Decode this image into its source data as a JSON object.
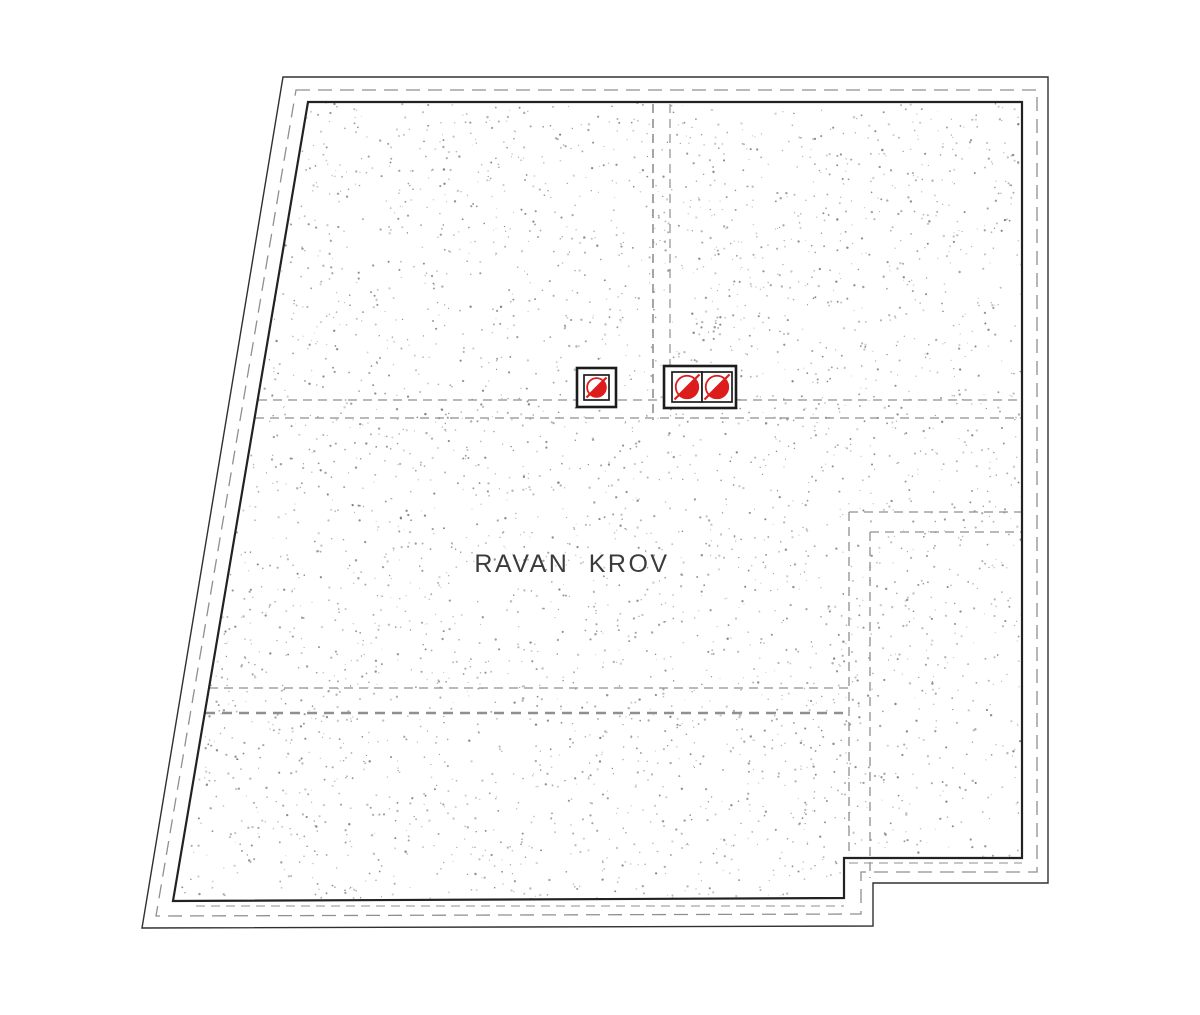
{
  "drawing": {
    "label": {
      "text": "RAVAN KROV"
    },
    "colors": {
      "background": "#ffffff",
      "outline": "#303030",
      "inner_outline": "#222222",
      "dashed": "#8f8f8f",
      "stipple": "#6f6f6f",
      "drain_frame": "#1c1c1c",
      "drain_red": "#dd1c1c",
      "label_text": "#3b3b3b"
    },
    "outer_polygon": [
      [
        283,
        77
      ],
      [
        1048,
        77
      ],
      [
        1048,
        883
      ],
      [
        873,
        883
      ],
      [
        873,
        926
      ],
      [
        142,
        928
      ]
    ],
    "offset_dashed_polygon": [
      [
        296,
        90
      ],
      [
        1037,
        90
      ],
      [
        1037,
        872
      ],
      [
        861,
        872
      ],
      [
        861,
        914
      ],
      [
        156,
        916
      ]
    ],
    "inner_polygon": [
      [
        308,
        102
      ],
      [
        1022,
        102
      ],
      [
        1022,
        858
      ],
      [
        844,
        858
      ],
      [
        844,
        898
      ],
      [
        173,
        901
      ]
    ],
    "hidden_lines": [
      {
        "name": "upper-hidden-line-1",
        "x1": 258,
        "y1": 400,
        "x2": 1022,
        "y2": 400,
        "weight": 1.3
      },
      {
        "name": "upper-hidden-line-2",
        "x1": 255,
        "y1": 418,
        "x2": 1022,
        "y2": 418,
        "weight": 1.3
      },
      {
        "name": "center-hidden-vertical-1",
        "x1": 653,
        "y1": 104,
        "x2": 653,
        "y2": 420,
        "weight": 1.6
      },
      {
        "name": "center-hidden-vertical-2",
        "x1": 670,
        "y1": 104,
        "x2": 670,
        "y2": 367,
        "weight": 1.2
      },
      {
        "name": "lower-hidden-line-1",
        "x1": 209,
        "y1": 688,
        "x2": 849,
        "y2": 688,
        "weight": 1.2
      },
      {
        "name": "lower-hidden-line-2",
        "x1": 205,
        "y1": 713,
        "x2": 843,
        "y2": 713,
        "weight": 2.4
      },
      {
        "name": "terrace-hidden-h-1",
        "x1": 849,
        "y1": 512,
        "x2": 1022,
        "y2": 512,
        "weight": 1.3
      },
      {
        "name": "terrace-hidden-v-1",
        "x1": 849,
        "y1": 512,
        "x2": 849,
        "y2": 858,
        "weight": 1.3
      },
      {
        "name": "terrace-hidden-h-2",
        "x1": 870,
        "y1": 532,
        "x2": 1022,
        "y2": 532,
        "weight": 1.3
      },
      {
        "name": "terrace-hidden-v-2",
        "x1": 870,
        "y1": 532,
        "x2": 870,
        "y2": 878,
        "weight": 1.3
      },
      {
        "name": "bottom-edge-hidden",
        "x1": 196,
        "y1": 906,
        "x2": 844,
        "y2": 906,
        "weight": 1.1
      },
      {
        "name": "notch-edge-hidden",
        "x1": 849,
        "y1": 863,
        "x2": 1022,
        "y2": 863,
        "weight": 1.1
      }
    ],
    "drains": [
      {
        "type": "single",
        "frame": {
          "x": 577,
          "y": 368,
          "w": 39,
          "h": 39
        },
        "cells": [
          {
            "x": 584,
            "y": 375,
            "w": 25,
            "h": 25
          }
        ]
      },
      {
        "type": "double",
        "frame": {
          "x": 664,
          "y": 366,
          "w": 72,
          "h": 42
        },
        "cells": [
          {
            "x": 672,
            "y": 372,
            "w": 30,
            "h": 30
          },
          {
            "x": 702,
            "y": 372,
            "w": 30,
            "h": 30
          }
        ]
      }
    ],
    "stipple": {
      "seed": 1337,
      "count": 3800
    }
  }
}
